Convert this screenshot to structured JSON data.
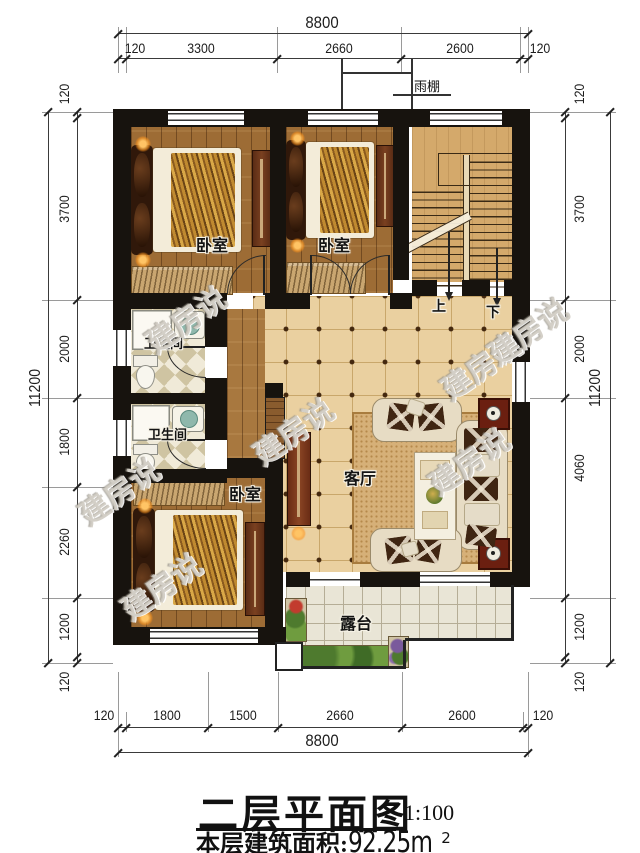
{
  "plan": {
    "rooms": {
      "bedroom1_label": "卧室",
      "bedroom2_label": "卧室",
      "bedroom3_label": "卧室",
      "bath1_label": "卫生间",
      "bath2_label": "卫生间",
      "living_label": "客厅",
      "terrace_label": "露台",
      "canopy_label": "雨棚",
      "stairs_up_label": "上",
      "stairs_down_label": "下"
    },
    "dimensions": {
      "top": {
        "total": "8800",
        "segments": [
          "120",
          "3300",
          "2660",
          "2600",
          "120"
        ]
      },
      "bottom": {
        "total": "8800",
        "segments": [
          "120",
          "1800",
          "1500",
          "2660",
          "2600",
          "120"
        ]
      },
      "left": {
        "total": "11200",
        "segments": [
          "120",
          "3700",
          "2000",
          "1800",
          "2260",
          "1200",
          "120"
        ]
      },
      "right": {
        "total": "11200",
        "segments": [
          "120",
          "3700",
          "2000",
          "4060",
          "1200",
          "120"
        ]
      }
    }
  },
  "title_block": {
    "title": "二层平面图",
    "scale": "1:100",
    "area_label": "本层建筑面积:",
    "area_value": "92.25m",
    "area_superscript": "2"
  },
  "watermark": {
    "text": "建房说"
  },
  "colors": {
    "wall": "#17130e",
    "wood_floor": "#9d6c35",
    "hall_tile": "#ead0a0",
    "terrace_tile": "#e9e5d6",
    "lamp_glow": "#f59b2d"
  }
}
